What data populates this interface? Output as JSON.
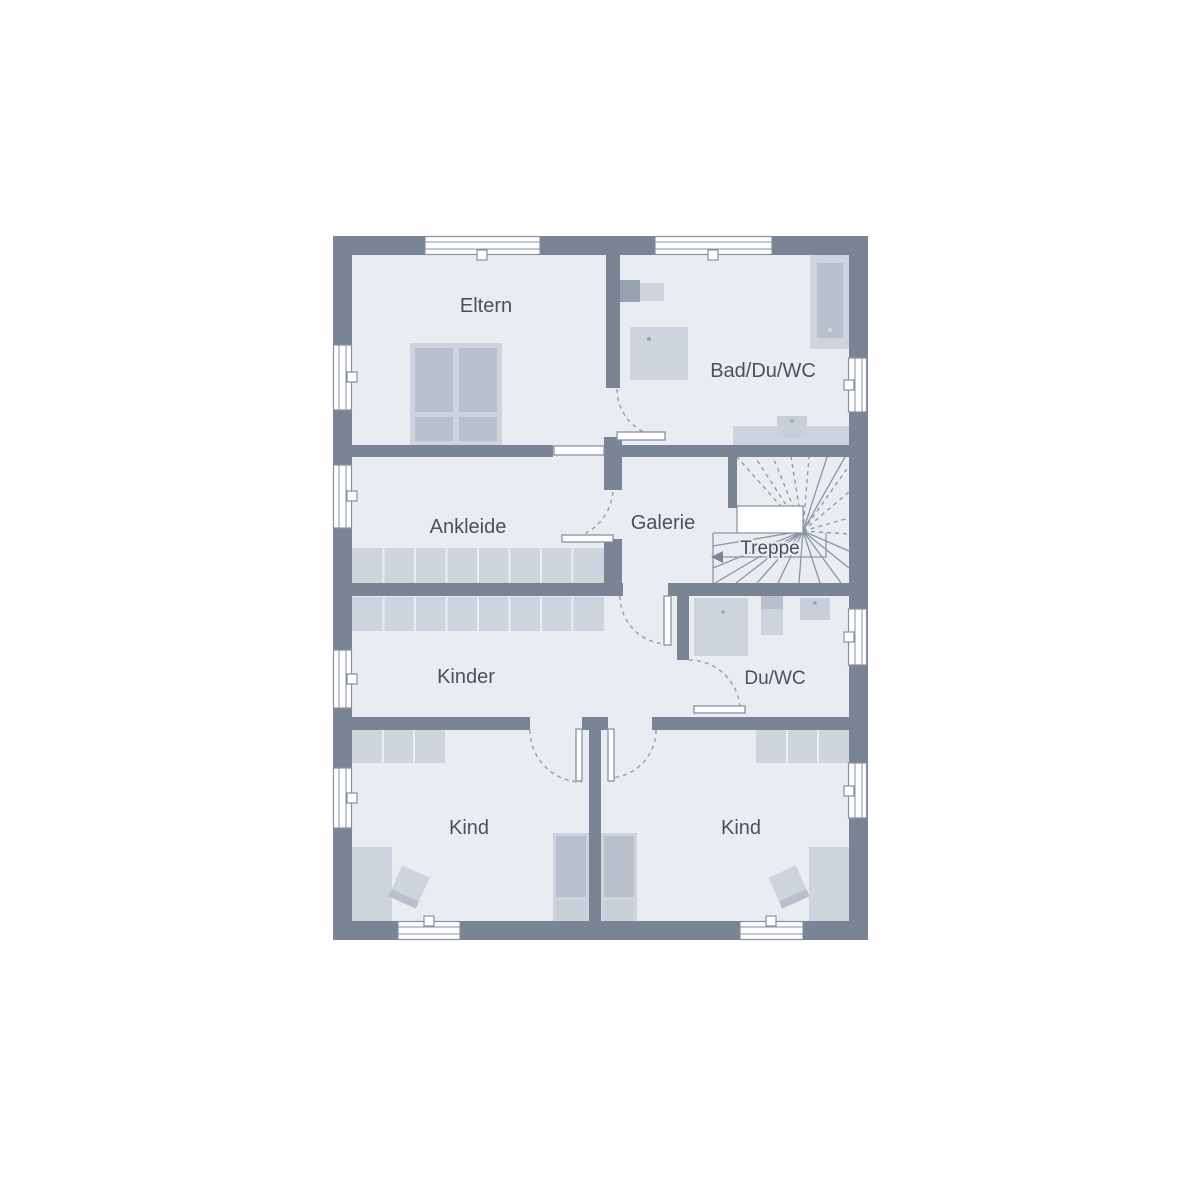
{
  "palette": {
    "background": "#ffffff",
    "wall": "#7b8495",
    "floor": "#e9edf2",
    "furniture_light": "#ced4dd",
    "furniture_mid": "#c9cfd9",
    "furniture_dark": "#b9c0cc",
    "line": "#8b95a4",
    "label_text": "#4b515b"
  },
  "rooms": [
    {
      "id": "eltern",
      "label": "Eltern"
    },
    {
      "id": "bad-du-wc",
      "label": "Bad/Du/WC"
    },
    {
      "id": "ankleide",
      "label": "Ankleide"
    },
    {
      "id": "galerie",
      "label": "Galerie"
    },
    {
      "id": "treppe",
      "label": "Treppe"
    },
    {
      "id": "kinder",
      "label": "Kinder"
    },
    {
      "id": "du-wc",
      "label": "Du/WC"
    },
    {
      "id": "kind-left",
      "label": "Kind"
    },
    {
      "id": "kind-right",
      "label": "Kind"
    }
  ],
  "symbols": [
    {
      "name": "double-bed-icon"
    },
    {
      "name": "single-bed-icon"
    },
    {
      "name": "bathtub-icon"
    },
    {
      "name": "shower-icon"
    },
    {
      "name": "toilet-icon"
    },
    {
      "name": "sink-icon"
    },
    {
      "name": "wardrobe-icon"
    },
    {
      "name": "desk-icon"
    },
    {
      "name": "chair-icon"
    },
    {
      "name": "stairs-icon"
    },
    {
      "name": "window-icon"
    },
    {
      "name": "door-swing-icon"
    }
  ]
}
